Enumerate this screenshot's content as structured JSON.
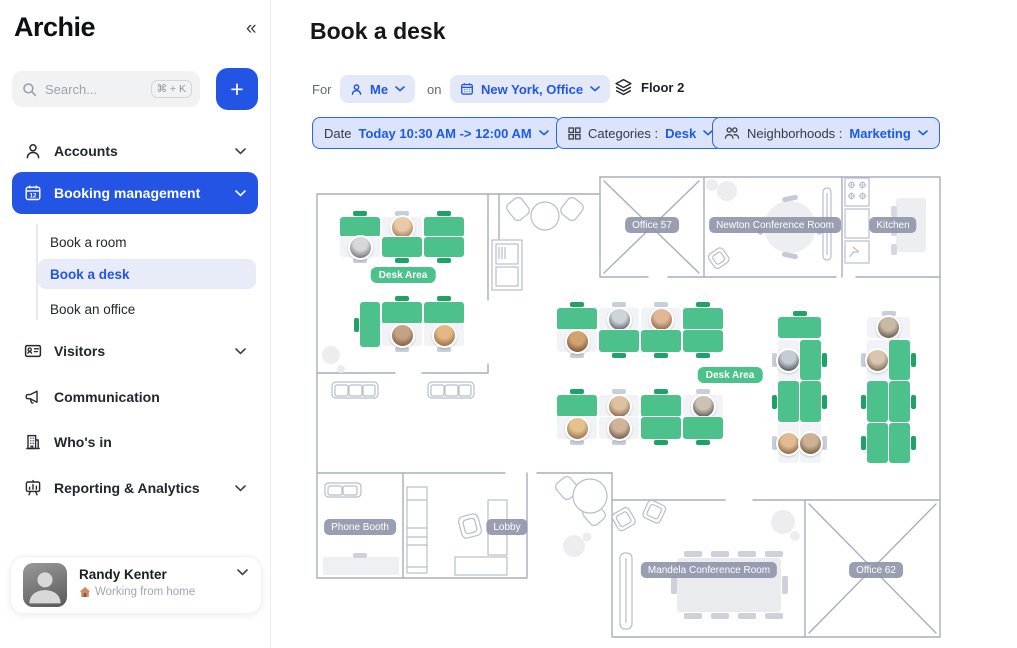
{
  "colors": {
    "accent_blue": "#2454e4",
    "desk_green": "#4cc18b",
    "desk_tab_green": "#1ea266",
    "wall_gray": "#a9aec0",
    "room_label_gray": "#8e93a8"
  },
  "app": {
    "logo": "Archie",
    "collapse_glyph": "«",
    "add_label": "+"
  },
  "search": {
    "placeholder": "Search...",
    "shortcut": "⌘ + K"
  },
  "sidebar": {
    "items": [
      {
        "label": "Accounts"
      },
      {
        "label": "Booking management"
      },
      {
        "label": "Visitors"
      },
      {
        "label": "Communication"
      },
      {
        "label": "Who's in"
      },
      {
        "label": "Reporting & Analytics"
      }
    ],
    "booking_children": [
      {
        "label": "Book a room"
      },
      {
        "label": "Book a desk"
      },
      {
        "label": "Book an office"
      }
    ],
    "user": {
      "name": "Randy Kenter",
      "status": "Working from home"
    }
  },
  "header": {
    "title": "Book a desk",
    "for_label": "For",
    "for_value": "Me",
    "on_label": "on",
    "location_value": "New York, Office",
    "floor_value": "Floor 2"
  },
  "filters": {
    "date_label": "Date",
    "date_value": "Today 10:30 AM -> 12:00 AM",
    "categories_label": "Categories :",
    "categories_value": "Desk",
    "neighborhoods_label": "Neighborhoods :",
    "neighborhoods_value": "Marketing"
  },
  "floorplan": {
    "room_labels": [
      {
        "text": "Office 57",
        "x": 344,
        "y": 57
      },
      {
        "text": "Newton Conference Room",
        "x": 467,
        "y": 57
      },
      {
        "text": "Kitchen",
        "x": 585,
        "y": 57
      },
      {
        "text": "Phone Booth",
        "x": 52,
        "y": 359
      },
      {
        "text": "Lobby",
        "x": 199,
        "y": 359
      },
      {
        "text": "Mandela Conference Room",
        "x": 401,
        "y": 402
      },
      {
        "text": "Office 62",
        "x": 568,
        "y": 402
      }
    ],
    "area_labels": [
      {
        "text": "Desk Area",
        "x": 95,
        "y": 107
      },
      {
        "text": "Desk Area",
        "x": 422,
        "y": 207
      }
    ],
    "avatar_palette": [
      [
        "#e8c9a8",
        "#8a6343"
      ],
      [
        "#d7d7d9",
        "#55565c"
      ],
      [
        "#c4a284",
        "#6b4a33"
      ],
      [
        "#e3b684",
        "#7d5a36"
      ],
      [
        "#cfd4da",
        "#3f454e"
      ],
      [
        "#e0b895",
        "#744f33"
      ],
      [
        "#d2a36f",
        "#5c4026"
      ],
      [
        "#dcc2a0",
        "#6d5038"
      ],
      [
        "#ccc2b4",
        "#3b3a40"
      ],
      [
        "#e5c18f",
        "#7a5c3a"
      ],
      [
        "#d0b49a",
        "#4f4236"
      ],
      [
        "#c6ccd4",
        "#2f343c"
      ],
      [
        "#e2bb93",
        "#6f5233"
      ],
      [
        "#cdb193",
        "#57422f"
      ],
      [
        "#c9b9a5",
        "#4a3e33"
      ],
      [
        "#d9c6b0",
        "#5f4c3c"
      ]
    ],
    "desks": [
      {
        "x": 32,
        "y": 49,
        "w": 40,
        "h": 20,
        "o": 0,
        "t": "t"
      },
      {
        "x": 74,
        "y": 49,
        "w": 40,
        "h": 20,
        "o": 1,
        "t": "t"
      },
      {
        "x": 116,
        "y": 49,
        "w": 40,
        "h": 20,
        "o": 0,
        "t": "t"
      },
      {
        "x": 32,
        "y": 69,
        "w": 40,
        "h": 20,
        "o": 1,
        "t": "b"
      },
      {
        "x": 74,
        "y": 69,
        "w": 40,
        "h": 20,
        "o": 0,
        "t": "b"
      },
      {
        "x": 116,
        "y": 69,
        "w": 40,
        "h": 20,
        "o": 0,
        "t": "b"
      },
      {
        "x": 52,
        "y": 134,
        "w": 20,
        "h": 45,
        "o": 0,
        "t": "l"
      },
      {
        "x": 74,
        "y": 134,
        "w": 40,
        "h": 22,
        "o": 0,
        "t": "t"
      },
      {
        "x": 116,
        "y": 134,
        "w": 40,
        "h": 22,
        "o": 0,
        "t": "t"
      },
      {
        "x": 74,
        "y": 156,
        "w": 40,
        "h": 22,
        "o": 1,
        "t": "b"
      },
      {
        "x": 116,
        "y": 156,
        "w": 40,
        "h": 22,
        "o": 1,
        "t": "b"
      },
      {
        "x": 249,
        "y": 140,
        "w": 40,
        "h": 22,
        "o": 0,
        "t": "t"
      },
      {
        "x": 291,
        "y": 140,
        "w": 40,
        "h": 22,
        "o": 1,
        "t": "t"
      },
      {
        "x": 333,
        "y": 140,
        "w": 40,
        "h": 22,
        "o": 1,
        "t": "t"
      },
      {
        "x": 375,
        "y": 140,
        "w": 40,
        "h": 22,
        "o": 0,
        "t": "t"
      },
      {
        "x": 249,
        "y": 162,
        "w": 40,
        "h": 22,
        "o": 1,
        "t": "b"
      },
      {
        "x": 291,
        "y": 162,
        "w": 40,
        "h": 22,
        "o": 0,
        "t": "b"
      },
      {
        "x": 333,
        "y": 162,
        "w": 40,
        "h": 22,
        "o": 0,
        "t": "b"
      },
      {
        "x": 375,
        "y": 162,
        "w": 40,
        "h": 22,
        "o": 0,
        "t": "b"
      },
      {
        "x": 249,
        "y": 227,
        "w": 40,
        "h": 22,
        "o": 0,
        "t": "t"
      },
      {
        "x": 291,
        "y": 227,
        "w": 40,
        "h": 22,
        "o": 1,
        "t": "t"
      },
      {
        "x": 333,
        "y": 227,
        "w": 40,
        "h": 22,
        "o": 0,
        "t": "t"
      },
      {
        "x": 375,
        "y": 227,
        "w": 40,
        "h": 22,
        "o": 1,
        "t": "t"
      },
      {
        "x": 249,
        "y": 249,
        "w": 40,
        "h": 22,
        "o": 1,
        "t": "b"
      },
      {
        "x": 291,
        "y": 249,
        "w": 40,
        "h": 22,
        "o": 1,
        "t": "b"
      },
      {
        "x": 333,
        "y": 249,
        "w": 40,
        "h": 22,
        "o": 0,
        "t": "b"
      },
      {
        "x": 375,
        "y": 249,
        "w": 40,
        "h": 22,
        "o": 0,
        "t": "b"
      },
      {
        "x": 470,
        "y": 149,
        "w": 43,
        "h": 21,
        "o": 0,
        "t": "t"
      },
      {
        "x": 470,
        "y": 172,
        "w": 21,
        "h": 40,
        "o": 1,
        "t": "l"
      },
      {
        "x": 492,
        "y": 172,
        "w": 21,
        "h": 40,
        "o": 0,
        "t": "r"
      },
      {
        "x": 470,
        "y": 213,
        "w": 21,
        "h": 41,
        "o": 0,
        "t": "l"
      },
      {
        "x": 492,
        "y": 213,
        "w": 21,
        "h": 41,
        "o": 0,
        "t": "r"
      },
      {
        "x": 470,
        "y": 255,
        "w": 21,
        "h": 40,
        "o": 1,
        "t": "l"
      },
      {
        "x": 492,
        "y": 255,
        "w": 21,
        "h": 40,
        "o": 1,
        "t": "r"
      },
      {
        "x": 559,
        "y": 149,
        "w": 43,
        "h": 21,
        "o": 1,
        "t": "t"
      },
      {
        "x": 559,
        "y": 172,
        "w": 21,
        "h": 40,
        "o": 1,
        "t": "l"
      },
      {
        "x": 581,
        "y": 172,
        "w": 21,
        "h": 40,
        "o": 0,
        "t": "r"
      },
      {
        "x": 559,
        "y": 213,
        "w": 21,
        "h": 41,
        "o": 0,
        "t": "l"
      },
      {
        "x": 581,
        "y": 213,
        "w": 21,
        "h": 41,
        "o": 0,
        "t": "r"
      },
      {
        "x": 559,
        "y": 255,
        "w": 21,
        "h": 40,
        "o": 0,
        "t": "l"
      },
      {
        "x": 581,
        "y": 255,
        "w": 21,
        "h": 40,
        "o": 0,
        "t": "r"
      }
    ]
  }
}
